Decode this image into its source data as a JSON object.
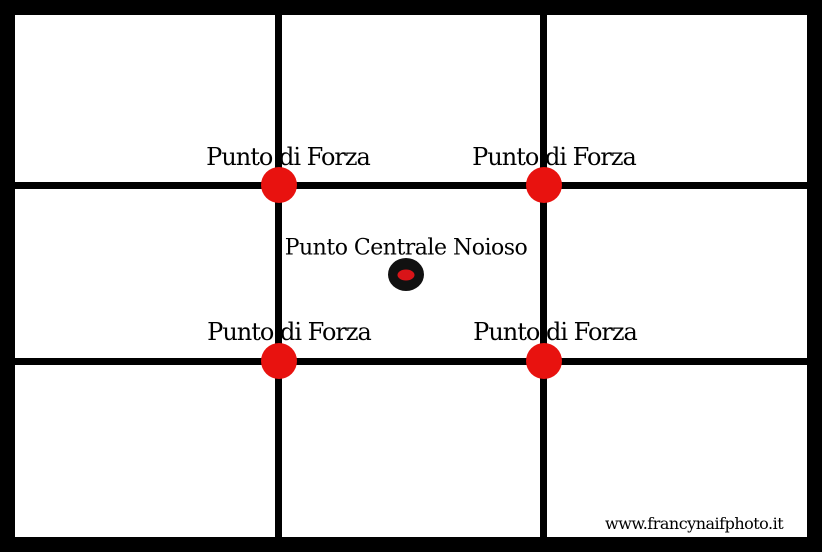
{
  "colors": {
    "background": "#ffffff",
    "frame": "#000000",
    "grid-line": "#000000",
    "strong-point": "#e8120f",
    "center-dot": "#111111",
    "center-dot-core": "#d91418",
    "watermark-bg": "#ffffff",
    "text": "#000000"
  },
  "labels": {
    "strong_points": [
      {
        "position": "top-left",
        "text": "Punto di Forza"
      },
      {
        "position": "top-right",
        "text": "Punto di Forza"
      },
      {
        "position": "bottom-left",
        "text": "Punto di Forza"
      },
      {
        "position": "bottom-right",
        "text": "Punto di Forza"
      }
    ],
    "center_point": {
      "text": "Punto Centrale Noioso"
    }
  },
  "watermark": {
    "text": "www.francynaifphoto.it"
  }
}
